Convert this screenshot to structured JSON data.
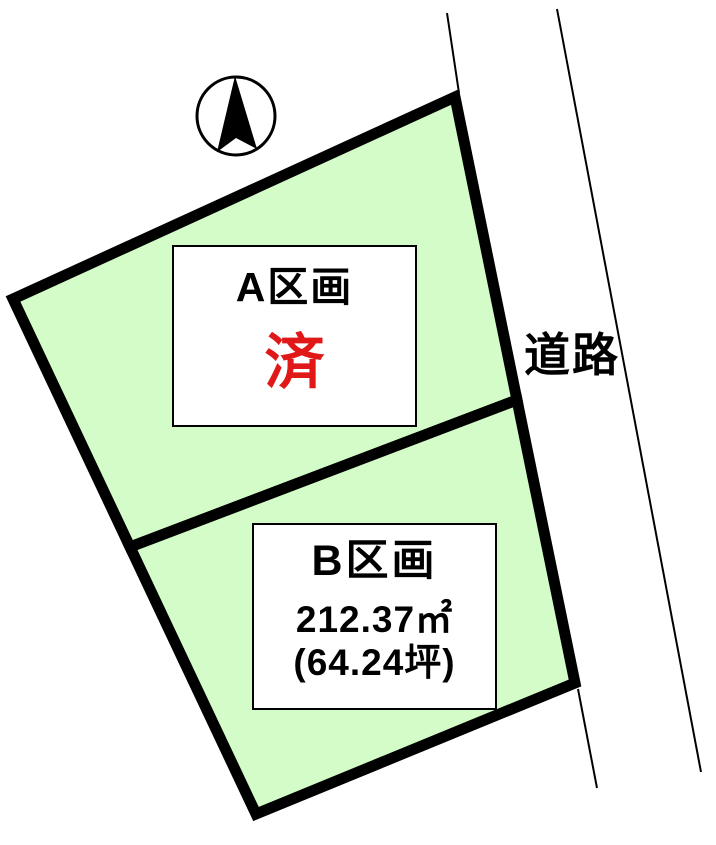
{
  "diagram": {
    "type": "land-plot-map",
    "compass": {
      "icon": "north-arrow-icon"
    },
    "parcels": [
      {
        "id": "A",
        "label": "A区画",
        "status": "済"
      },
      {
        "id": "B",
        "label": "B区画",
        "area_m2": "212.37㎡",
        "area_tsubo": "(64.24坪)"
      }
    ],
    "road_label": "道路",
    "colors": {
      "parcel_fill": "#d4fcc8",
      "outline": "#000000",
      "status_red": "#e01818",
      "background": "#ffffff"
    }
  }
}
